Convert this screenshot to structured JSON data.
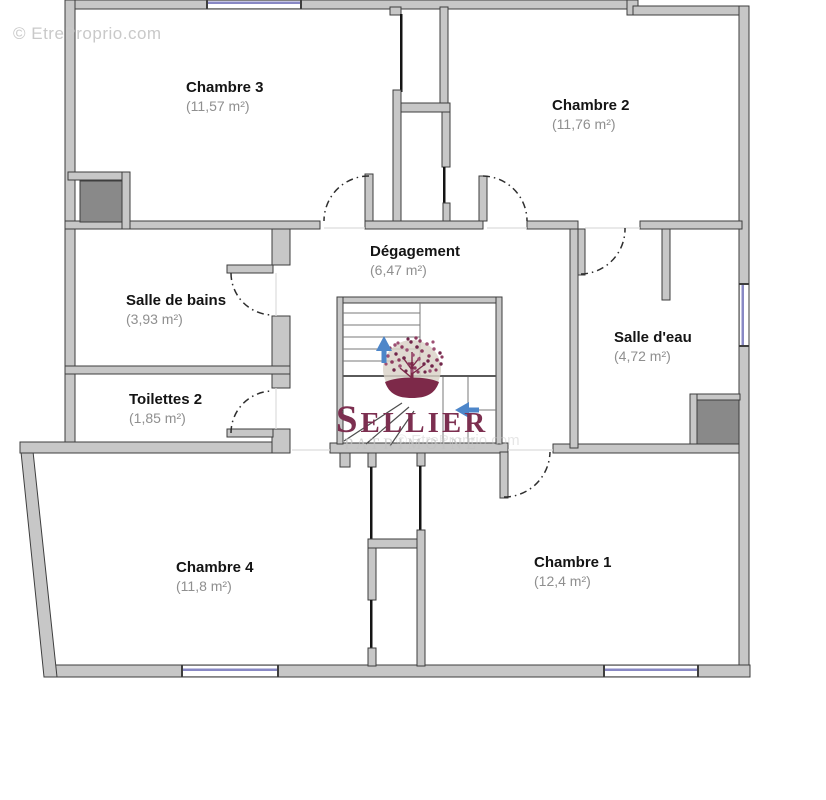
{
  "watermark": {
    "text": "© EtreProprio.com"
  },
  "logo": {
    "brand": "Sellier",
    "tagline": "Patrimoine",
    "symbol": "tree-icon"
  },
  "rooms": [
    {
      "id": "chambre-3",
      "name": "Chambre 3",
      "area": "(11,57 m²)"
    },
    {
      "id": "chambre-2",
      "name": "Chambre 2",
      "area": "(11,76 m²)"
    },
    {
      "id": "degagement",
      "name": "Dégagement",
      "area": "(6,47 m²)"
    },
    {
      "id": "salle-de-bains",
      "name": "Salle de bains",
      "area": "(3,93 m²)"
    },
    {
      "id": "salle-d-eau",
      "name": "Salle d'eau",
      "area": "(4,72 m²)"
    },
    {
      "id": "toilettes-2",
      "name": "Toilettes 2",
      "area": "(1,85 m²)"
    },
    {
      "id": "chambre-4",
      "name": "Chambre 4",
      "area": "(11,8 m²)"
    },
    {
      "id": "chambre-1",
      "name": "Chambre 1",
      "area": "(12,4 m²)"
    }
  ],
  "stairs": {
    "direction_arrows": [
      "up",
      "left"
    ]
  },
  "colors": {
    "wall": "#c7c7c7",
    "outline": "#3e3e3e",
    "shaft": "#898989",
    "thin": "#141414",
    "window": "#8888c4",
    "arrow": "#4d86c9",
    "brand": "#7c2f50",
    "ground": "#7d2949",
    "circle": "#d9d2c7",
    "watermark": "#c9c9c9",
    "label": "#141414",
    "area": "#8f8f8f",
    "tread": "#7a7a7a"
  }
}
